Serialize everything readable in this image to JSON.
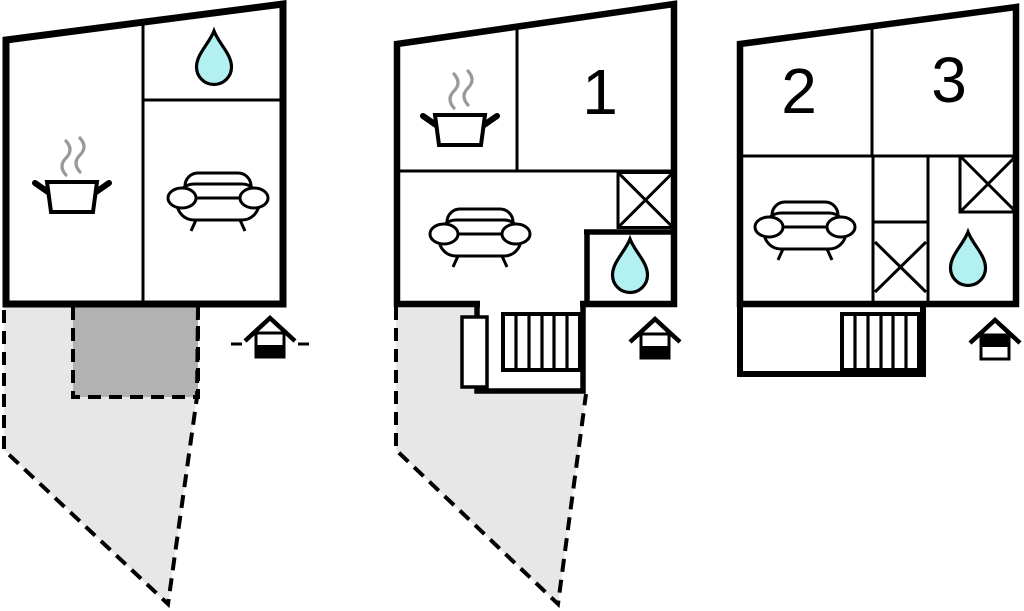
{
  "colors": {
    "wall": "#000000",
    "terrace-light": "#e7e7e7",
    "terrace-dark": "#b2b2b2",
    "water": "#b3f0f2",
    "steam": "#999999",
    "canvas": "#ffffff"
  },
  "floorplans": [
    {
      "name": "left-unit-ground-floor",
      "room_numbers": [],
      "rooms": [
        "kitchen",
        "bathroom",
        "living-room"
      ],
      "outdoor": [
        "terrace",
        "covered-terrace"
      ],
      "entrance_level": "ground",
      "icons": [
        "cooking-pot-icon",
        "water-drop-icon",
        "sofa-icon",
        "entrance-ground-icon"
      ]
    },
    {
      "name": "middle-unit-ground-floor",
      "room_numbers": [
        "1"
      ],
      "rooms": [
        "kitchen",
        "bedroom",
        "living-room",
        "bathroom",
        "wardrobe",
        "stairwell"
      ],
      "outdoor": [
        "terrace"
      ],
      "entrance_level": "ground",
      "icons": [
        "cooking-pot-icon",
        "water-drop-icon",
        "sofa-icon",
        "wardrobe-cross-icon",
        "stairs-icon",
        "entrance-ground-icon"
      ]
    },
    {
      "name": "right-unit-upper-floor",
      "room_numbers": [
        "2",
        "3"
      ],
      "rooms": [
        "bedroom",
        "bedroom",
        "living-room",
        "bathroom",
        "wardrobe",
        "stairwell"
      ],
      "outdoor": [],
      "entrance_level": "upper",
      "icons": [
        "sofa-icon",
        "water-drop-icon",
        "wardrobe-cross-icon",
        "stairs-icon",
        "entrance-upper-icon"
      ]
    }
  ]
}
